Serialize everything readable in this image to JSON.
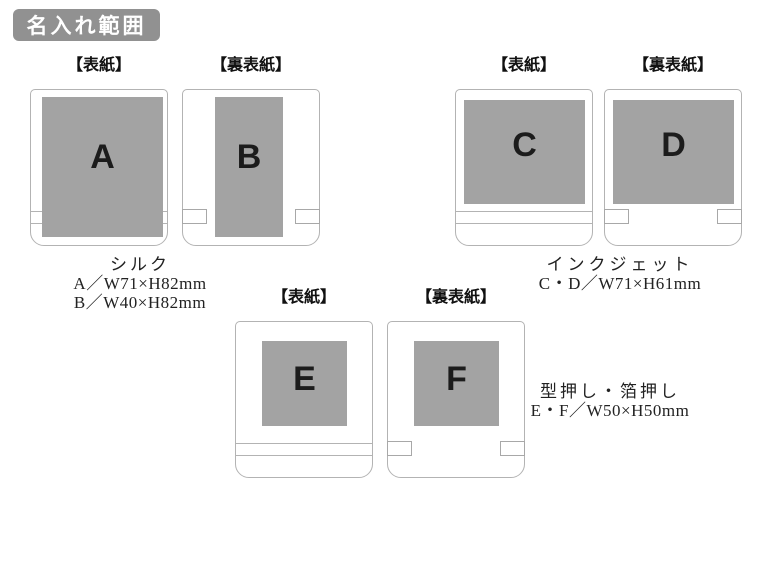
{
  "badge": {
    "label": "名入れ範囲"
  },
  "colors": {
    "badge_bg": "#919191",
    "area_fill": "#a3a3a3",
    "panel_border": "#b3b3b3",
    "letter_color": "#1c1c1c"
  },
  "groups": [
    {
      "name": "silk",
      "panels": [
        {
          "label": "【表紙】",
          "letter": "A"
        },
        {
          "label": "【裏表紙】",
          "letter": "B"
        }
      ],
      "caption": {
        "method": "シルク",
        "line1": "A／W71×H82mm",
        "line2": "B／W40×H82mm"
      }
    },
    {
      "name": "inkjet",
      "panels": [
        {
          "label": "【表紙】",
          "letter": "C"
        },
        {
          "label": "【裏表紙】",
          "letter": "D"
        }
      ],
      "caption": {
        "method": "インクジェット",
        "line1": "C・D／W71×H61mm"
      }
    },
    {
      "name": "emboss-foil",
      "panels": [
        {
          "label": "【表紙】",
          "letter": "E"
        },
        {
          "label": "【裏表紙】",
          "letter": "F"
        }
      ],
      "caption": {
        "method": "型押し・箔押し",
        "line1": "E・F／W50×H50mm"
      }
    }
  ]
}
